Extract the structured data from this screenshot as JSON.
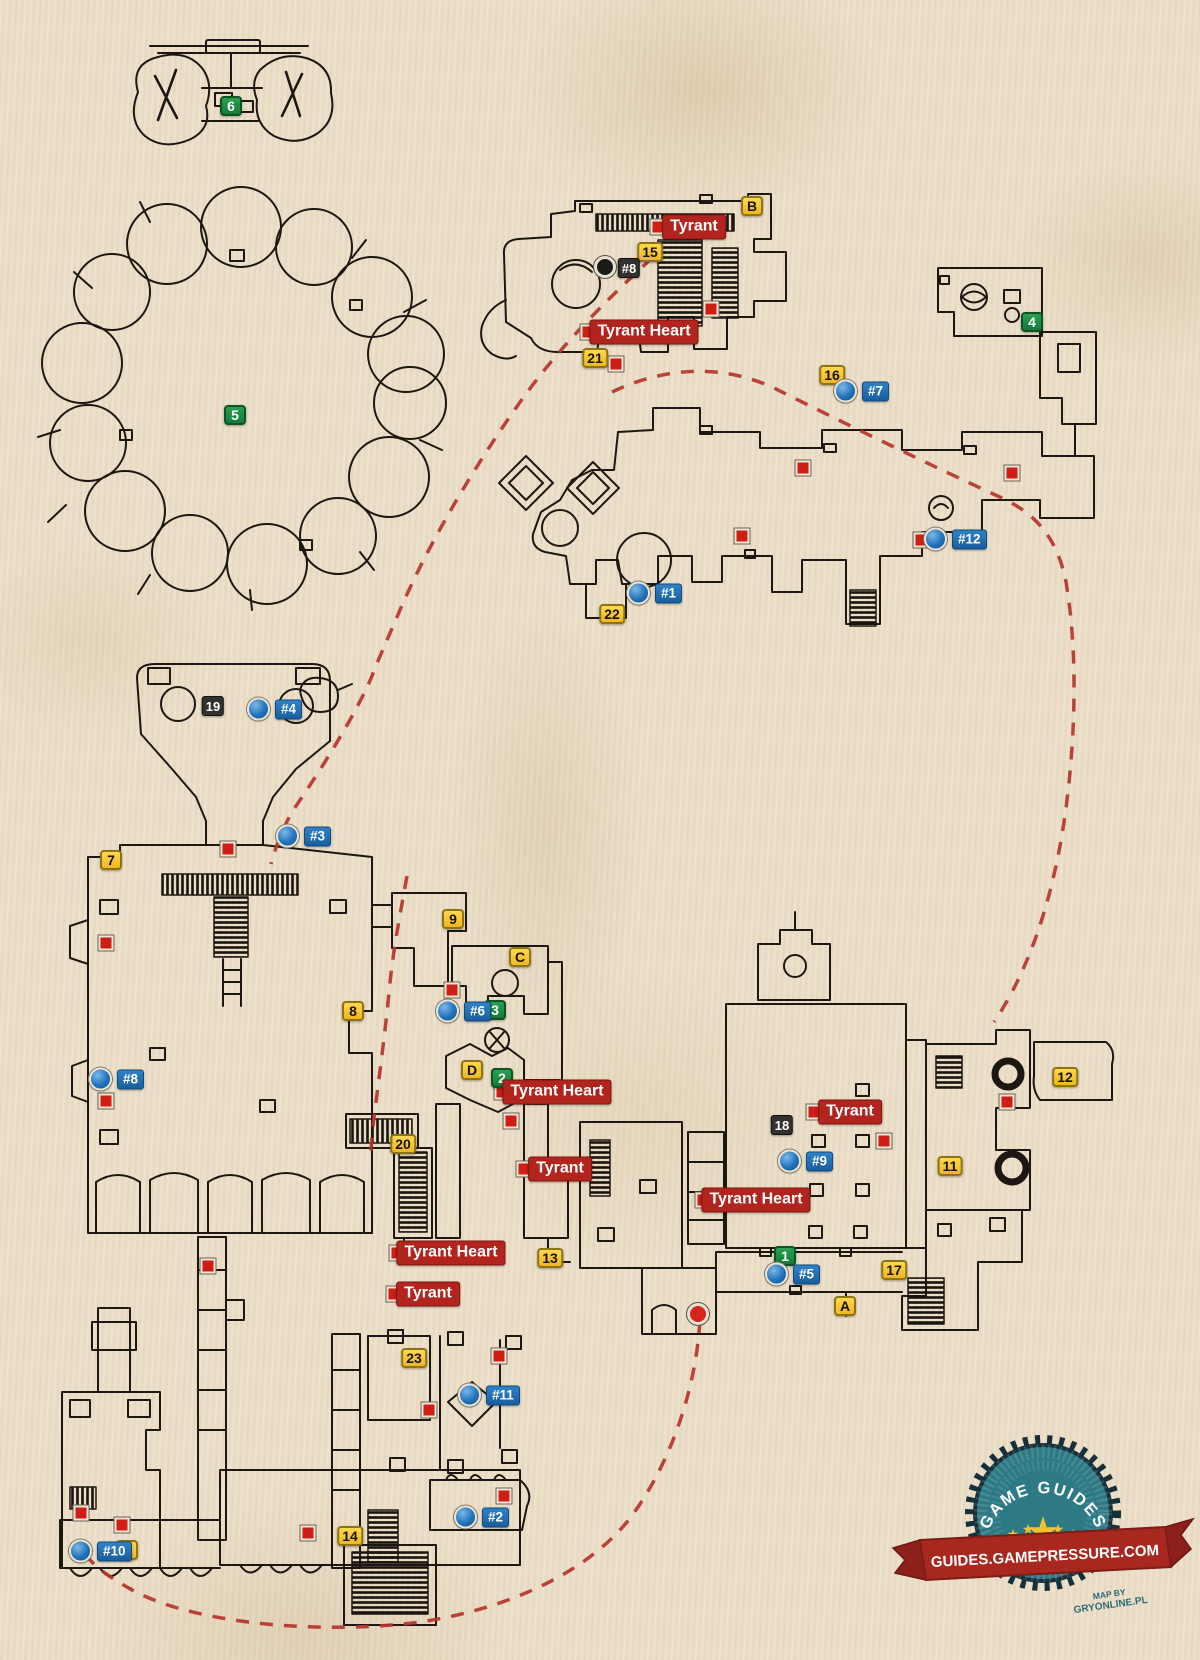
{
  "page": {
    "width": 1200,
    "height": 1660,
    "background": "#ecdfc8"
  },
  "colors": {
    "parchment": "#ecdfc8",
    "wall_ink": "#1c1712",
    "route_red": "#b5342c",
    "marker_yellow": "#f6c22b",
    "marker_green": "#1f9143",
    "marker_blue": "#1f6cb4",
    "boss_label_red": "#b2251e",
    "black_plate": "#33312e",
    "badge_teal": "#2d7a85",
    "badge_navy": "#16303b",
    "badge_ribbon": "#a8281f",
    "star_yellow": "#f2c230"
  },
  "legend_markers": {
    "yellow_numbers": [
      {
        "label": "7",
        "x": 111,
        "y": 860
      },
      {
        "label": "8",
        "x": 353,
        "y": 1011
      },
      {
        "label": "9",
        "x": 453,
        "y": 919
      },
      {
        "label": "11",
        "x": 950,
        "y": 1166
      },
      {
        "label": "12",
        "x": 1065,
        "y": 1077
      },
      {
        "label": "13",
        "x": 550,
        "y": 1258
      },
      {
        "label": "14",
        "x": 350,
        "y": 1536
      },
      {
        "label": "15",
        "x": 650,
        "y": 252
      },
      {
        "label": "16",
        "x": 832,
        "y": 375
      },
      {
        "label": "17",
        "x": 894,
        "y": 1270
      },
      {
        "label": "20",
        "x": 403,
        "y": 1144
      },
      {
        "label": "21",
        "x": 595,
        "y": 358
      },
      {
        "label": "22",
        "x": 612,
        "y": 614
      },
      {
        "label": "23",
        "x": 414,
        "y": 1358
      },
      {
        "label": "0",
        "x": 127,
        "y": 1550
      }
    ],
    "yellow_letters": [
      {
        "label": "A",
        "x": 845,
        "y": 1306
      },
      {
        "label": "B",
        "x": 752,
        "y": 206
      },
      {
        "label": "C",
        "x": 520,
        "y": 957
      },
      {
        "label": "D",
        "x": 472,
        "y": 1070
      }
    ],
    "green_numbers": [
      {
        "label": "1",
        "x": 785,
        "y": 1256
      },
      {
        "label": "2",
        "x": 502,
        "y": 1078
      },
      {
        "label": "3",
        "x": 495,
        "y": 1010
      },
      {
        "label": "4",
        "x": 1032,
        "y": 322
      },
      {
        "label": "5",
        "x": 235,
        "y": 415
      },
      {
        "label": "6",
        "x": 231,
        "y": 106
      }
    ],
    "black_plates": [
      {
        "label": "19",
        "x": 213,
        "y": 706
      },
      {
        "label": "18",
        "x": 782,
        "y": 1125
      },
      {
        "label": "#8",
        "x": 629,
        "y": 268
      }
    ],
    "blue_points": [
      {
        "label": "#1",
        "x": 637,
        "y": 593
      },
      {
        "label": "#2",
        "x": 464,
        "y": 1517
      },
      {
        "label": "#3",
        "x": 286,
        "y": 836
      },
      {
        "label": "#4",
        "x": 257,
        "y": 709
      },
      {
        "label": "#5",
        "x": 775,
        "y": 1274
      },
      {
        "label": "#6",
        "x": 446,
        "y": 1011
      },
      {
        "label": "#7",
        "x": 844,
        "y": 391
      },
      {
        "label": "#8",
        "x": 99,
        "y": 1079
      },
      {
        "label": "#9",
        "x": 788,
        "y": 1161
      },
      {
        "label": "#10",
        "x": 79,
        "y": 1551
      },
      {
        "label": "#11",
        "x": 468,
        "y": 1395
      },
      {
        "label": "#12",
        "x": 934,
        "y": 539
      }
    ],
    "red_labels": [
      {
        "text": "Tyrant",
        "x": 694,
        "y": 227,
        "sq": 658
      },
      {
        "text": "Tyrant Heart",
        "x": 644,
        "y": 332,
        "sq": 588
      },
      {
        "text": "Tyrant Heart",
        "x": 557,
        "y": 1092,
        "sq": 502
      },
      {
        "text": "Tyrant",
        "x": 560,
        "y": 1169,
        "sq": 524
      },
      {
        "text": "Tyrant Heart",
        "x": 451,
        "y": 1253,
        "sq": 397
      },
      {
        "text": "Tyrant",
        "x": 428,
        "y": 1294,
        "sq": 394
      },
      {
        "text": "Tyrant",
        "x": 850,
        "y": 1112,
        "sq": 814
      },
      {
        "text": "Tyrant Heart",
        "x": 756,
        "y": 1200,
        "sq": 703
      }
    ],
    "red_squares": [
      [
        711,
        309
      ],
      [
        616,
        364
      ],
      [
        803,
        468
      ],
      [
        1012,
        473
      ],
      [
        742,
        536
      ],
      [
        921,
        540
      ],
      [
        228,
        849
      ],
      [
        106,
        943
      ],
      [
        452,
        990
      ],
      [
        106,
        1101
      ],
      [
        511,
        1121
      ],
      [
        1007,
        1102
      ],
      [
        884,
        1141
      ],
      [
        208,
        1266
      ],
      [
        499,
        1356
      ],
      [
        429,
        1410
      ],
      [
        504,
        1496
      ],
      [
        308,
        1533
      ],
      [
        81,
        1513
      ],
      [
        122,
        1525
      ]
    ],
    "special_points": [
      {
        "type": "black-circle",
        "x": 605,
        "y": 267
      },
      {
        "type": "red-circle",
        "x": 698,
        "y": 1314
      }
    ]
  },
  "routes": {
    "left": "M652,258 C612,295 560,345 518,405 C472,470 428,545 400,610 C385,645 378,660 372,676 C356,714 322,768 296,806 C285,822 276,845 271,864",
    "mid": "M407,876 C400,915 393,950 389,992 C385,1035 378,1085 373,1126 C372,1136 371,1146 371,1154",
    "right": "M612,392 C658,370 718,360 778,390 C846,424 932,466 1002,498 C1040,516 1058,542 1066,582 C1078,652 1076,742 1064,822 C1052,902 1028,972 994,1022",
    "bottom": "M700,1320 C696,1388 672,1458 636,1510 C592,1574 502,1610 420,1622 C330,1634 202,1626 136,1592 C106,1576 88,1562 80,1546"
  },
  "badge": {
    "arc_text": "GAME GUIDES",
    "ribbon_text": "GUIDES.GAMEPRESSURE.COM",
    "credit_line1": "MAP BY",
    "credit_line2": "GRYONLINE.PL"
  }
}
